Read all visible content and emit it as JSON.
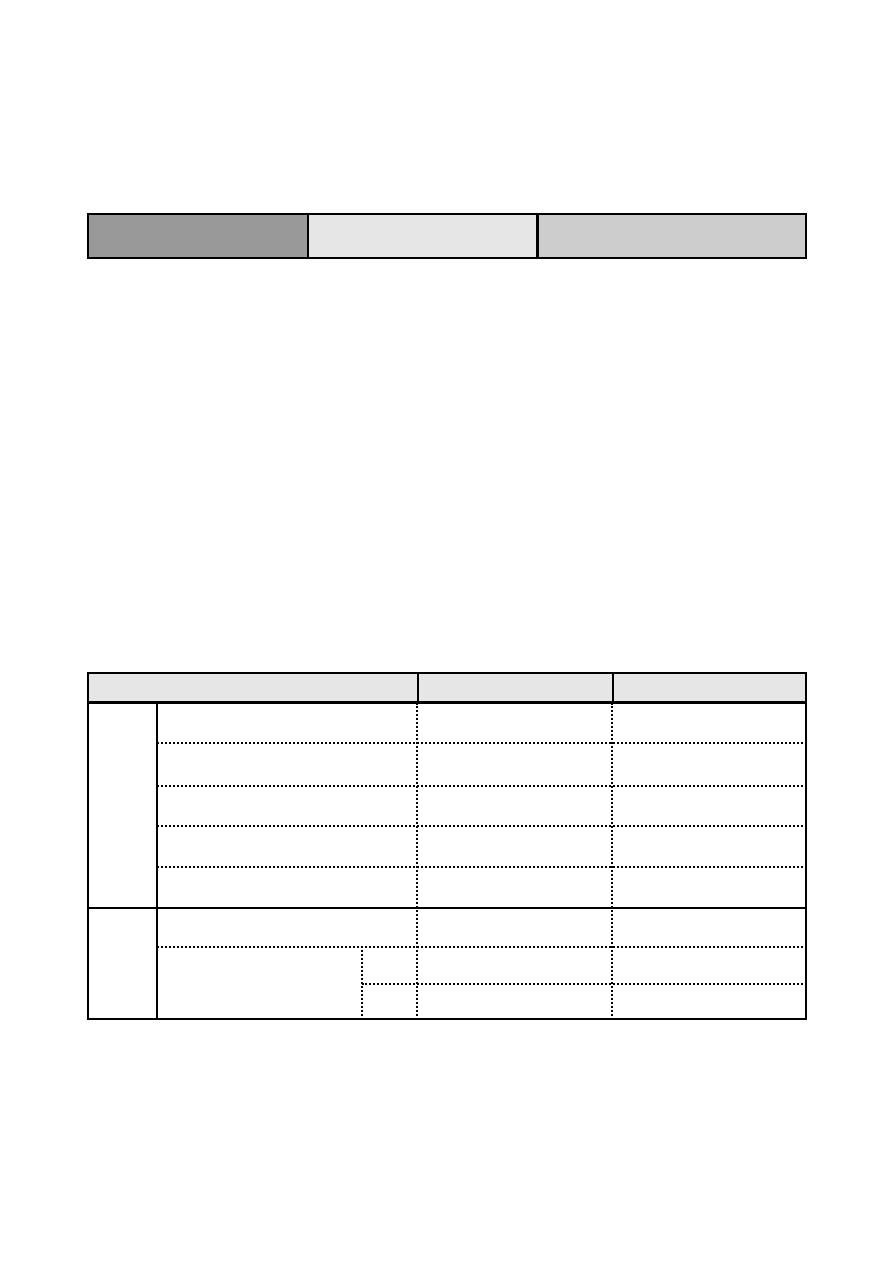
{
  "page": {
    "background": "#ffffff"
  },
  "top_bar": {
    "border_color": "#000000",
    "cells": [
      {
        "label": "",
        "fill": "#999999"
      },
      {
        "label": "",
        "fill": "#e6e6e6"
      },
      {
        "label": "",
        "fill": "#cccccc"
      }
    ]
  },
  "main_table": {
    "border_color": "#000000",
    "header": {
      "fill": "#e6e6e6",
      "columns": [
        {
          "label": ""
        },
        {
          "label": ""
        },
        {
          "label": ""
        }
      ]
    },
    "body": {
      "group1": {
        "row_count": 5,
        "rows": [
          {
            "col1": "",
            "col2": "",
            "col3": ""
          },
          {
            "col1": "",
            "col2": "",
            "col3": ""
          },
          {
            "col1": "",
            "col2": "",
            "col3": ""
          },
          {
            "col1": "",
            "col2": "",
            "col3": ""
          },
          {
            "col1": "",
            "col2": "",
            "col3": ""
          }
        ]
      },
      "group2": {
        "row_count": 3,
        "rows": [
          {
            "col1": "",
            "col2": "",
            "col3": ""
          },
          {
            "col1": "",
            "sub": "",
            "col2": "",
            "col3": ""
          },
          {
            "col1": "",
            "sub": "",
            "col2": "",
            "col3": ""
          }
        ]
      }
    }
  }
}
